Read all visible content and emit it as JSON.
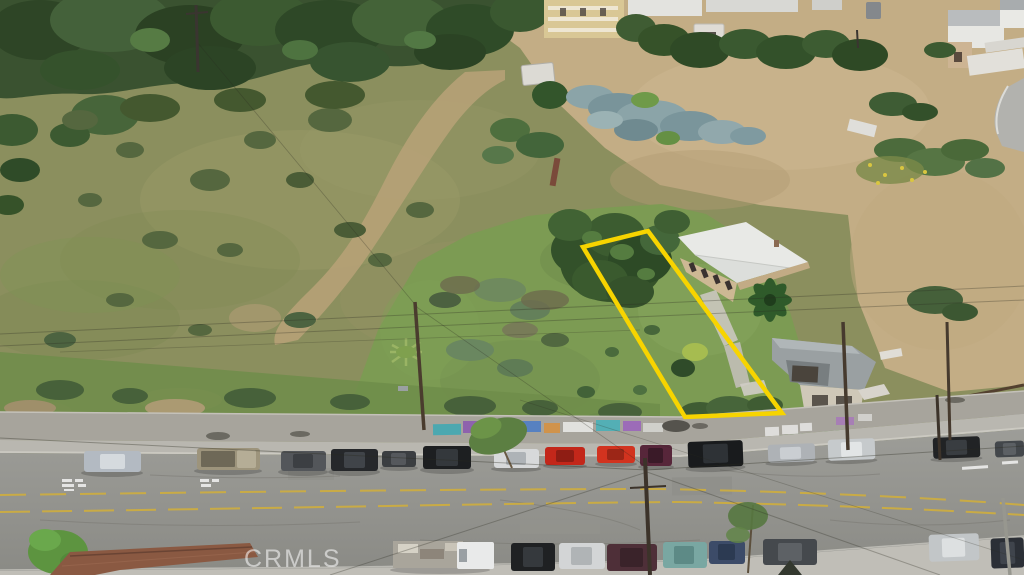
{
  "scene": {
    "type": "aerial-drone-photo",
    "description": "Aerial view of a vacant hillside residential lot outlined in yellow, beside a white-roofed house, above a street lined with parked cars and a graffiti retaining wall",
    "watermark": "CRMLS",
    "boundary_color": "#f7d400"
  },
  "palette": {
    "hillside_grass": "#8b8f5e",
    "dry_dirt": "#c3ad85",
    "lot_grass": "#7c9b53",
    "dark_trees": "#3a5230",
    "road_asphalt": "#979792",
    "retaining_wall": "#a7a49c",
    "sidewalk": "#b9b7b0",
    "white_roof": "#e8e9e6",
    "tile_roof": "#8a5942",
    "center_line_yellow": "#cfae3e"
  }
}
